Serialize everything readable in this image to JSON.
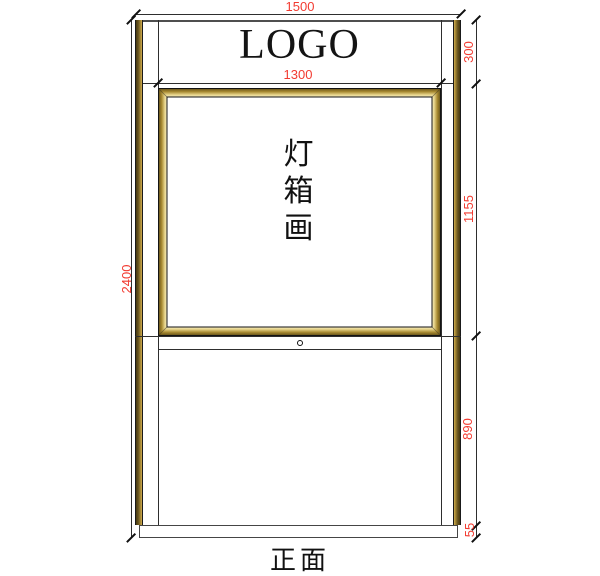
{
  "drawing": {
    "view_label": "正面",
    "logo": "LOGO",
    "lightbox_text": {
      "char1": "灯",
      "char2": "箱",
      "char3": "画"
    },
    "dims": {
      "total_width": "1500",
      "total_height": "2400",
      "header_height": "300",
      "inner_width": "1300",
      "lightbox_height": "1155",
      "lower_height": "890",
      "base_height": "55"
    },
    "colors": {
      "dimension_text": "#f23b31",
      "drawing_line": "#2e2e2e",
      "gold_dark": "#584717",
      "gold_mid": "#a5872f",
      "gold_pale": "#f6eec4"
    }
  }
}
